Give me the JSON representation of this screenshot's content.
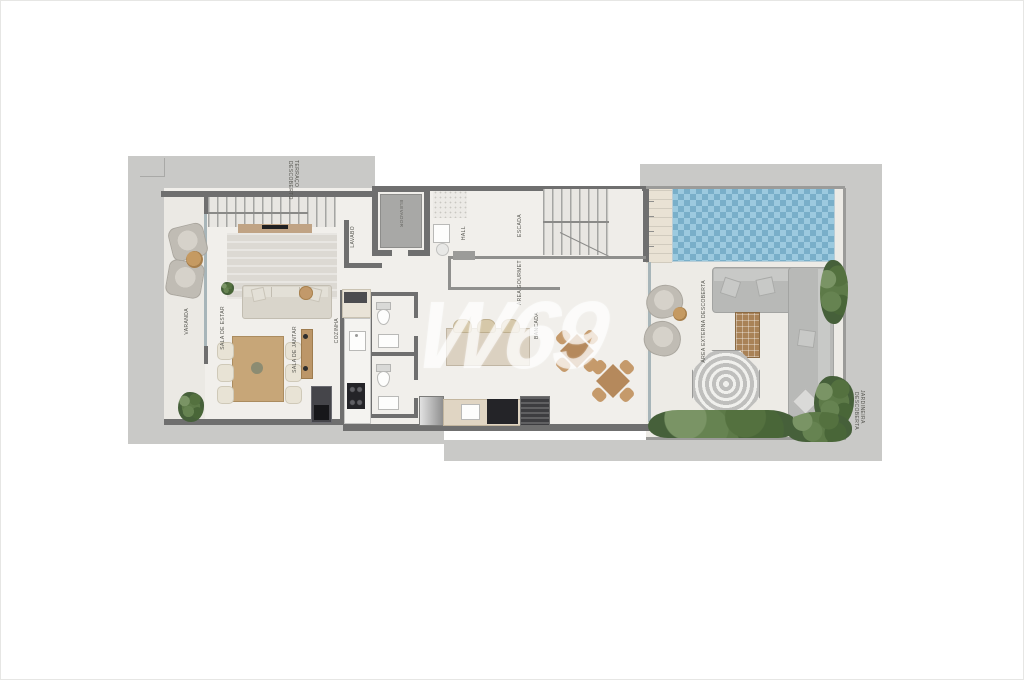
{
  "plan": {
    "type": "penthouse-floor-plan",
    "watermark": "W69",
    "labels": {
      "terraco_line1": "TERRAÇO",
      "terraco_line2": "DESCOBERTO",
      "elevador": "ELEVADOR",
      "lavabo": "LAVABO",
      "hall": "HALL",
      "escada": "ESCADA",
      "sala_estar": "SALA DE ESTAR",
      "sala_jantar": "SALA DE JANTAR",
      "varanda": "VARANDA",
      "cozinha": "COZINHA",
      "area_gourmet": "ÁREA GOURMET",
      "bancada": "BANCADA",
      "area_externa": "ÁREA EXTERNA DESCOBERTA",
      "jardineira_line1": "JARDINEIRA",
      "jardineira_line2": "DESCOBERTA"
    }
  }
}
